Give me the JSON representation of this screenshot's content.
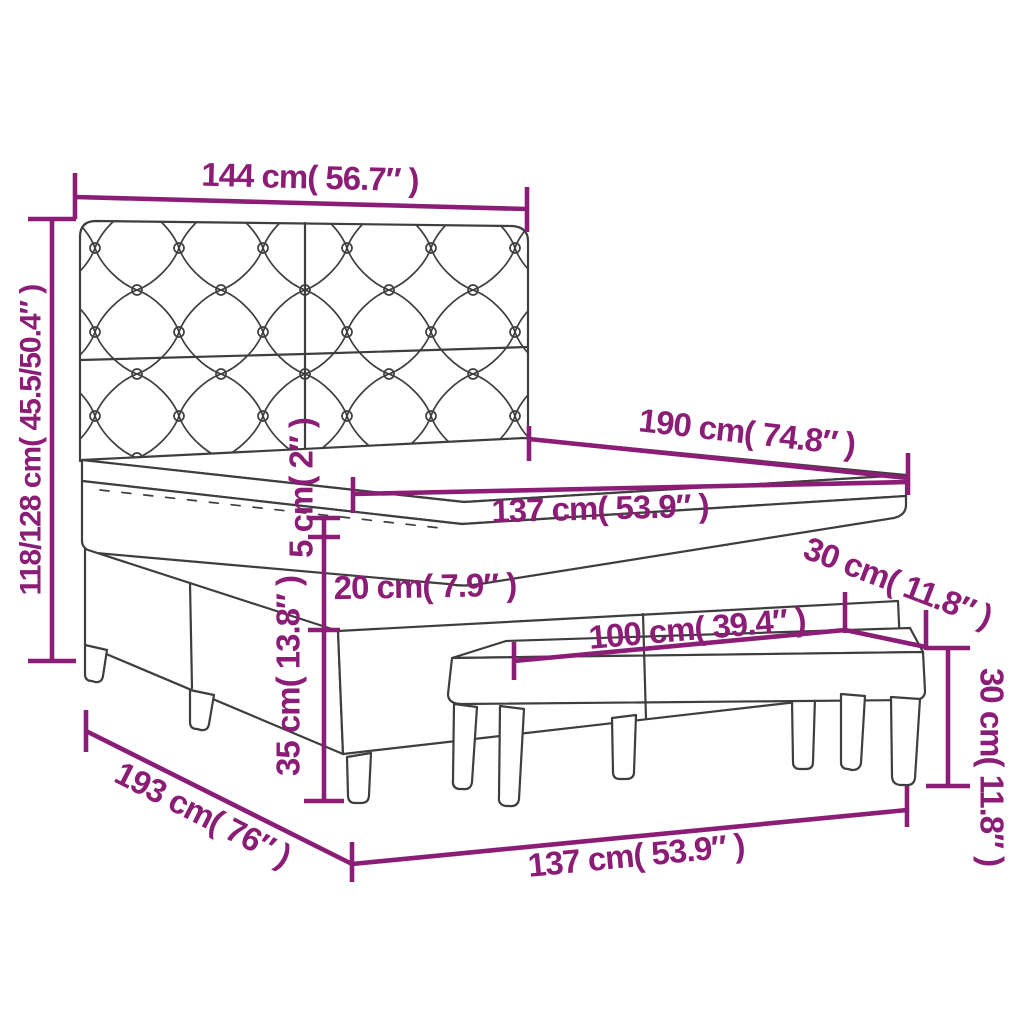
{
  "page": {
    "background_color": "#ffffff",
    "accent_color": "#8c1d76",
    "sketch_line_color": "#3e3e3e",
    "subject": "box spring bed with tufted headboard, mattress topper and bench — dimension diagram"
  },
  "diagram": {
    "parts": {
      "headboard": "tufted headboard",
      "mattress": "mattress with topper",
      "base": "box spring base with legs",
      "bench": "bench with legs"
    },
    "labels": {
      "headboard_width": "144 cm( 56.7″ )",
      "overall_height": "118/128 cm( 45.5/50.4″ )",
      "bed_length": "190 cm( 74.8″ )",
      "mattress_width": "137 cm( 53.9″ )",
      "topper_thickness": "5 cm( 2″ )",
      "mattress_thickness": "20 cm( 7.9″ )",
      "base_height": "35 cm( 13.8″ )",
      "bench_depth": "30 cm( 11.8″ )",
      "bench_height": "30 cm( 11.8″ )",
      "bench_length": "100 cm( 39.4″ )",
      "overall_length": "193 cm( 76″ )",
      "base_width": "137 cm( 53.9″ )"
    }
  }
}
